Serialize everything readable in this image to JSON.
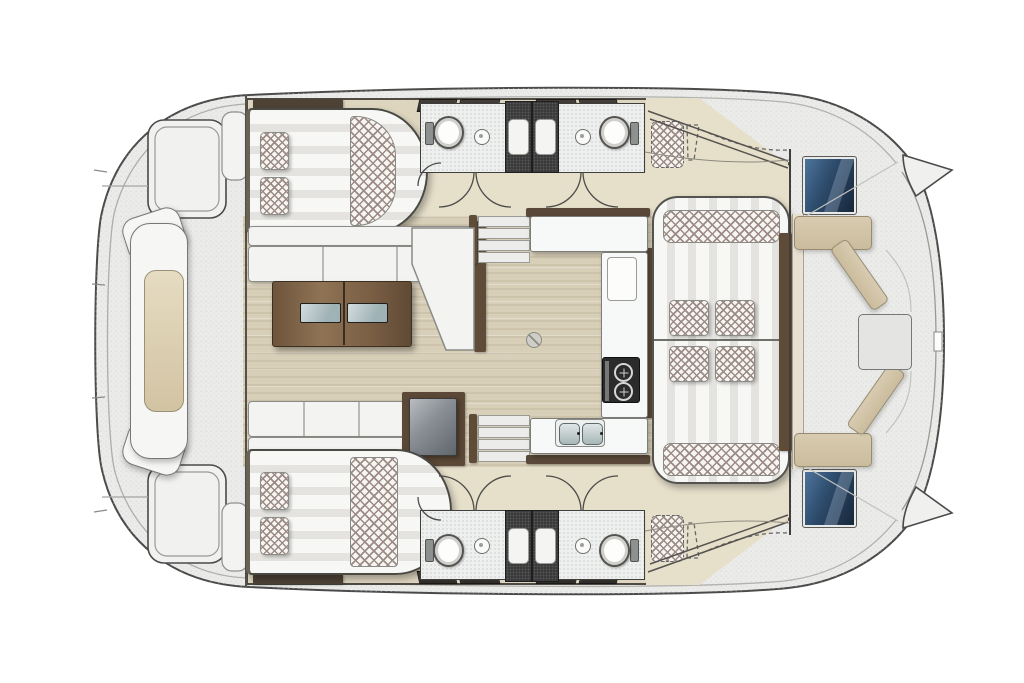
{
  "vessel": "catamaran interior floor plan, top-down view, bow to the right",
  "orientation": {
    "bow": "right",
    "stern": "left",
    "port": "top",
    "starboard": "bottom"
  },
  "palette": {
    "outline": "#4a4a4a",
    "deck": "#ebebea",
    "deck-speck": "#c9c9c6",
    "gunwale": "#b2b2af",
    "hull-floor": "#ded5bf",
    "corridor-floor": "#e6dfca",
    "salon-floor": "#d8cfb8",
    "bath-floor": "#eef0ef",
    "counter": "#f7f8f8",
    "cushion": "#f3f3f1",
    "stripe-light": "#f7f7f5",
    "stripe-dark": "#e4e3df",
    "checker-ink": "#9c8b84",
    "checker-bg": "#f7f5f2",
    "charcoal": "#3a3a3a",
    "wood-trim": "#5f4c38",
    "steel-dark": "#6e757b",
    "steel-light": "#b9bdc1",
    "glass-a": "#4e749b",
    "glass-b": "#2c4a6a",
    "glass-c": "#18273a",
    "pad-a": "#e6dcc2",
    "pad-b": "#d2c3a2",
    "bench-beige": "#d8cbb0",
    "table-glass-a": "#d3dcdd",
    "table-glass-b": "#9fb2b6"
  },
  "elements": {
    "floorplan": "catamaran yacht layout plan",
    "stern_platform": "stern platform with swim steps",
    "aft_lounge": "aft-deck lounge module with cushion",
    "aft_wing_seat": "aft wing seat",
    "transom_step": "transom boarding step",
    "cabin_bed": "hull cabin double berth with pillows",
    "bed_runner": "checkered bed runner",
    "bathroom": "bathroom with toilet and washbasin",
    "shower": "shower cubicle with tray",
    "toilet": "toilet",
    "washbasin": "round washbasin",
    "companionway": "companionway steps down to hull",
    "salon_sofa": "saloon L-shaped sofa",
    "salon_bench": "saloon bench seat",
    "salon_table": "saloon coffee table with glass inserts",
    "fridge": "fridge / cabinet unit",
    "galley_counter": "galley worktop",
    "stove": "two-burner stove",
    "double_sink": "double sink",
    "worktop_board": "worktop insert board",
    "table_mount": "table-leg floor mount",
    "forward_daybed": "forward double daybed with pillows",
    "windshield": "coachroof windshield",
    "deck_hatch": "tinted deck hatch",
    "foredeck": "foredeck",
    "foredeck_bench": "foredeck bench",
    "foredeck_table": "foredeck table pad",
    "bow_tip": "bow tip",
    "crew_berth": "optional forepeak berth (dashed)",
    "hull_window": "hull window strip",
    "door": "door swing arc"
  }
}
